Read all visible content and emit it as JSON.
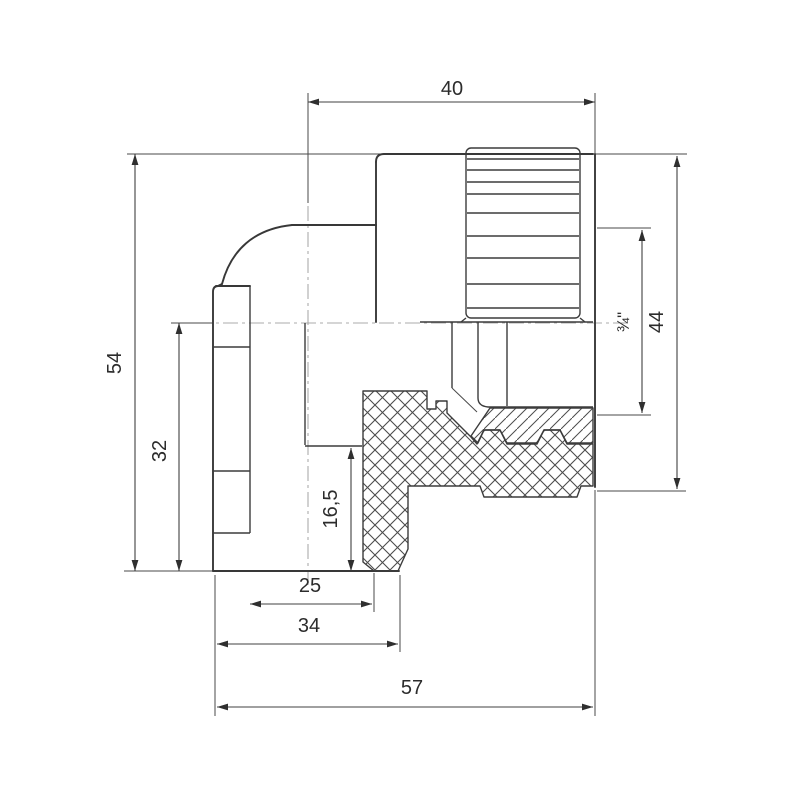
{
  "drawing": {
    "description": "Technical cross-section drawing of a 90-degree pipe elbow fitting with knurled female threaded insert and down-facing pipe socket",
    "background_color": "#ffffff",
    "line_color": "#3c3c3c",
    "centerline_color": "#ababab",
    "dimensions": {
      "d40": {
        "label": "40",
        "meaning": "axis to threaded end face, top"
      },
      "d54": {
        "label": "54",
        "meaning": "overall height, left"
      },
      "d32": {
        "label": "32",
        "meaning": "horizontal axis to socket mouth, left"
      },
      "d165": {
        "label": "16,5",
        "meaning": "socket insertion depth, inner"
      },
      "d25": {
        "label": "25",
        "meaning": "socket bore diameter, bottom"
      },
      "d34": {
        "label": "34",
        "meaning": "socket outer diameter, bottom"
      },
      "d57": {
        "label": "57",
        "meaning": "overall width, bottom"
      },
      "d34in": {
        "label": "¾\"",
        "meaning": "thread size, right"
      },
      "d44": {
        "label": "44",
        "meaning": "outer diameter of threaded end, right"
      }
    }
  }
}
